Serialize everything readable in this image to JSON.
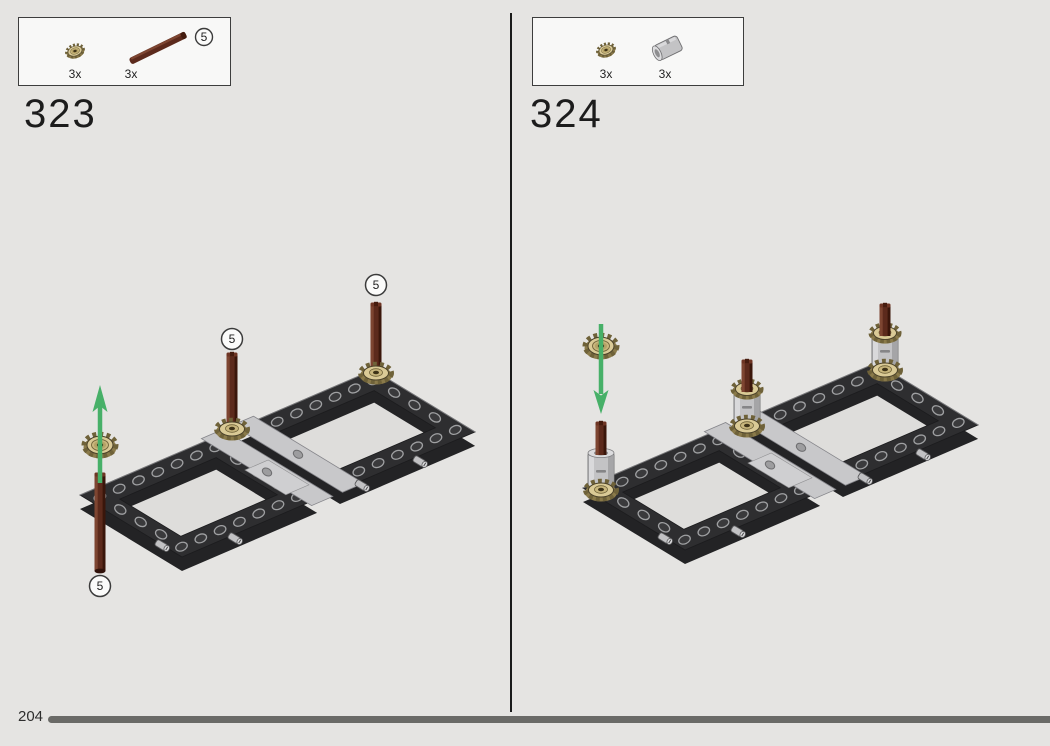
{
  "page": {
    "number": "204"
  },
  "panels": [
    {
      "step": "323",
      "axle_callout": "5",
      "parts": [
        {
          "name": "technic-bevel-gear-12-tooth-tan",
          "qty": "3x"
        },
        {
          "name": "technic-axle-5-reddish-brown",
          "qty": "3x",
          "length_callout": "5"
        }
      ]
    },
    {
      "step": "324",
      "parts": [
        {
          "name": "technic-bevel-gear-12-tooth-tan",
          "qty": "3x"
        },
        {
          "name": "technic-axle-connector-light-gray",
          "qty": "3x"
        }
      ]
    }
  ],
  "colors": {
    "background": "#E5E4E2",
    "frame_dark": "#2E2E30",
    "beam_light_gray": "#C8C8CA",
    "axle_brown": "#5C2A1C",
    "gear_tan": "#DACA96",
    "connector_gray": "#C3C3C5",
    "arrow_green": "#47B068",
    "progress_bar": "#6A6A67",
    "divider": "#1A1A1A"
  }
}
